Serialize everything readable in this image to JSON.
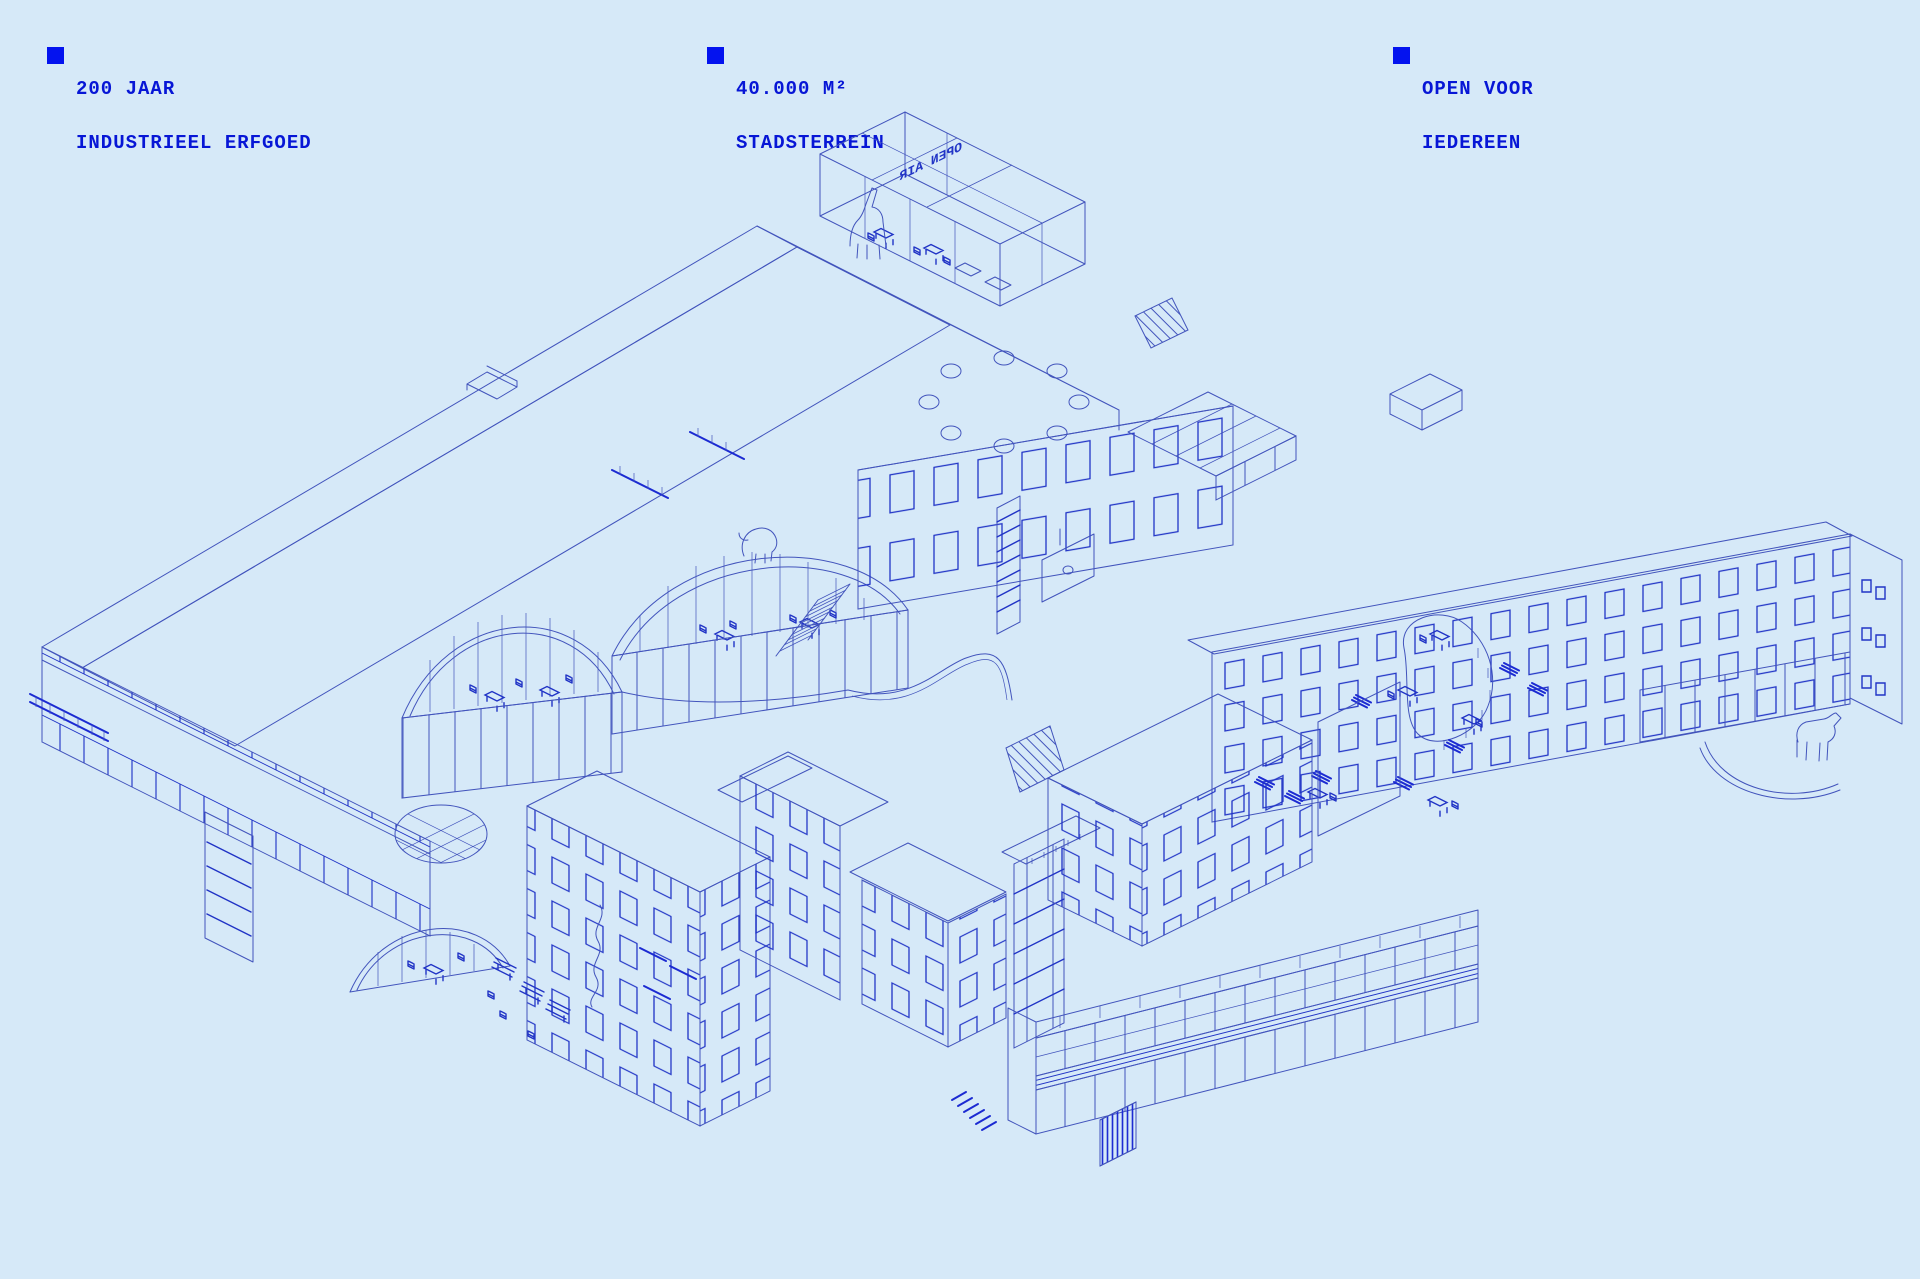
{
  "poster": {
    "background_color": "#d6e9f8",
    "line_color": "#4254bc",
    "accent_color": "#2134c6",
    "text_color": "#0716d6",
    "bullet_color": "#0413ef",
    "stats": [
      {
        "id": "heritage",
        "line1": "200 JAAR",
        "line2": "INDUSTRIEEL ERFGOED"
      },
      {
        "id": "area",
        "line1": "40.000 M²",
        "line2": "STADSTERREIN"
      },
      {
        "id": "open",
        "line1": "OPEN VOOR",
        "line2": "IEDEREEN"
      }
    ],
    "illustration": {
      "type": "axonometric-line-drawing",
      "subject": "industrial heritage site masterplan with rooftop pavilion, skylight ring, cutaway dome interiors, courtyard blocks and glazed gallery",
      "rooftop_sign": "OPEN AIR"
    }
  }
}
